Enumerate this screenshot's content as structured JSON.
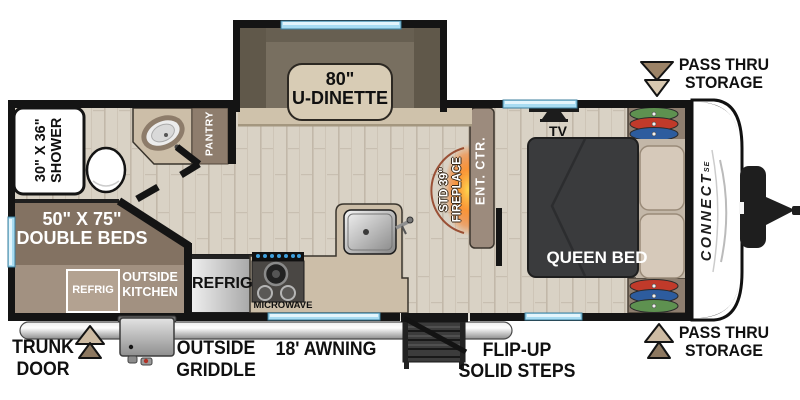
{
  "floorplan": {
    "brand": {
      "name": "CONNECT",
      "series": "SE"
    },
    "callouts": {
      "pass_thru_top": {
        "line1": "PASS THRU",
        "line2": "STORAGE"
      },
      "pass_thru_bottom": {
        "line1": "PASS THRU",
        "line2": "STORAGE"
      },
      "trunk_door": {
        "line1": "TRUNK",
        "line2": "DOOR"
      },
      "outside_griddle": {
        "line1": "OUTSIDE",
        "line2": "GRIDDLE"
      },
      "awning": {
        "label": "18' AWNING"
      },
      "flip_up_steps": {
        "line1": "FLIP-UP",
        "line2": "SOLID STEPS"
      }
    },
    "rooms": {
      "dinette": {
        "line1": "80\"",
        "line2": "U-DINETTE"
      },
      "shower": {
        "line1": "30\" X 36\"",
        "line2": "SHOWER"
      },
      "pantry": {
        "label": "PANTRY"
      },
      "tv": {
        "label": "TV"
      },
      "fireplace": {
        "line1": "STD 39\"",
        "line2": "FIREPLACE"
      },
      "ent_ctr": {
        "label": "ENT. CTR."
      },
      "queen_bed": {
        "label": "QUEEN BED"
      },
      "double_beds": {
        "line1": "50\" X 75\"",
        "line2": "DOUBLE BEDS"
      },
      "outside_kitchen": {
        "refrig": "REFRIG",
        "line1": "OUTSIDE",
        "line2": "KITCHEN"
      },
      "refrigerator": {
        "label": "REFRIG"
      },
      "microwave": {
        "label": "MICROWAVE"
      }
    },
    "colors": {
      "wall": "#141414",
      "floor": "#d9d2c5",
      "cabinet_brown": "#8e7e6f",
      "counter_tan": "#ccbea8",
      "bed_dark": "#3a3b3d",
      "window_blue": "#a8dcf2",
      "flame_orange": "#ff7b1f",
      "arrow_tan": "#cdbba3",
      "bench_khaki": "#6e6657"
    }
  }
}
